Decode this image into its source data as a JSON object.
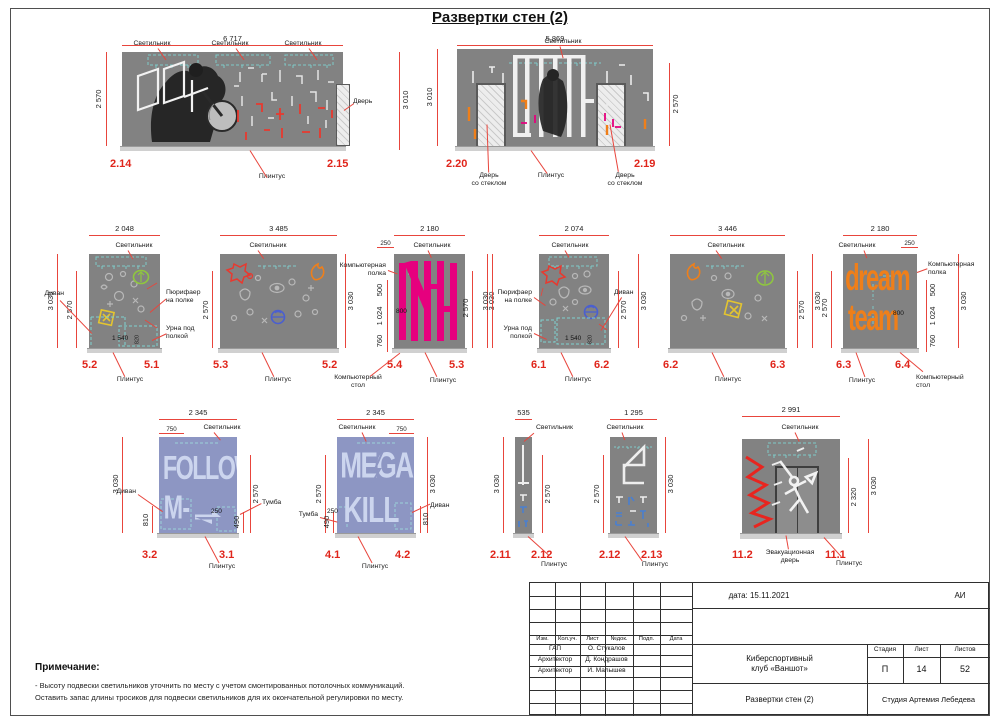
{
  "sheet": {
    "title": "Развертки стен (2)"
  },
  "colors": {
    "wall_gray": "#828282",
    "wall_periwinkle": "#8d96c3",
    "dim_red": "#e8453c",
    "id_red": "#e0251b",
    "lamp_teal": "#7fd2d0",
    "magenta": "#e6007e",
    "orange": "#ef7f1a"
  },
  "labels": {
    "lamp": "Светильник",
    "plinth": "Плинтус",
    "door": "Дверь",
    "glass_door": "Дверь\nсо стеклом",
    "sofa": "Диван",
    "purifier": "Пюрифаер\nна полке",
    "urn": "Урна под\nполкой",
    "shelf": "Компьютерная\nполка",
    "desk": "Компьютерный\nстол",
    "tumba": "Тумба",
    "evac_door": "Эвакуационная\nдверь"
  },
  "art": {
    "follow_line1": "FOLLOW",
    "follow_line2": "M-",
    "mega_line1": "MEGA",
    "mega_line2": "KILL",
    "dream_line1": "dream",
    "dream_line2": "team"
  },
  "walls": {
    "w2_14": {
      "top": "6 717",
      "h_left": "2 570",
      "h_right": "3 010",
      "id_left": "2.14",
      "id_right": "2.15"
    },
    "w2_20": {
      "top": "5 869",
      "h_left": "3 010",
      "h_right": "2 570",
      "id_left": "2.20",
      "id_right": "2.19"
    },
    "w5_2": {
      "top": "2 048",
      "h_out": "3 030",
      "h_in": "2 570",
      "w_in": "1 540",
      "h_small": "820",
      "id_left": "5.2",
      "id_right": "5.1"
    },
    "w5_3": {
      "top": "3 485",
      "h_left": "2 570",
      "h_right": "3 030",
      "id_left": "5.3",
      "id_right": "5.2"
    },
    "w5_4": {
      "top": "2 180",
      "offset": "250",
      "s1": "500",
      "s2": "1 024",
      "s3": "760",
      "inner": "800",
      "h_in": "2 570",
      "h_out": "3 030",
      "id_left": "5.4",
      "id_right": "5.3"
    },
    "w6_1": {
      "top": "2 074",
      "h_out_left": "3 030",
      "h_in": "2 570",
      "h_out_right": "3 030",
      "w_in": "1 540",
      "h_small": "820",
      "id_left": "6.1",
      "id_right": "6.2"
    },
    "w6_2": {
      "top": "3 446",
      "h_in": "2 570",
      "h_out": "3 030",
      "id_left": "6.2",
      "id_right": "6.3"
    },
    "w6_3": {
      "top": "2 180",
      "offset": "250",
      "h_left": "2 570",
      "s1": "500",
      "s2": "1 024",
      "s3": "760",
      "inner": "800",
      "h_out": "3 030",
      "id_left": "6.3",
      "id_right": "6.4"
    },
    "w3_2": {
      "top": "2 345",
      "offset": "750",
      "h_left": "3 030",
      "h_right": "2 570",
      "sofa": "810",
      "tumba": "490",
      "inner": "250",
      "id_left": "3.2",
      "id_right": "3.1"
    },
    "w4_1": {
      "top": "2 345",
      "offset": "750",
      "h_left": "2 570",
      "h_right": "3 030",
      "tumba": "490",
      "sofa": "810",
      "inner": "250",
      "id_left": "4.1",
      "id_right": "4.2"
    },
    "w2_11": {
      "top": "535",
      "h_left": "3 030",
      "h_right": "2 570",
      "id_left": "2.11",
      "id_right": "2.12"
    },
    "w2_12": {
      "top": "1 295",
      "h_left": "2 570",
      "h_right": "3 030",
      "id_left": "2.12",
      "id_right": "2.13"
    },
    "w11_2": {
      "top": "2 991",
      "h_in": "2 320",
      "h_out": "3 030",
      "id_left": "11.2",
      "id_right": "11.1"
    }
  },
  "note": {
    "title": "Примечание:",
    "line1": "- Высоту подвески светильников уточнить по месту с учетом смонтированных потолочных коммуникаций.",
    "line2": "Оставить запас длины тросиков для подвески светильников для их окончательной регулировки по месту."
  },
  "titleblock": {
    "date": "дата: 15.11.2021",
    "code": "АИ",
    "h_izm": "Изм.",
    "h_kol": "Кол.уч.",
    "h_list": "Лист",
    "h_ndoc": "№док.",
    "h_podp": "Подп.",
    "h_data": "Дата",
    "r1c1": "ГАП",
    "r1c2": "О. Стукалов",
    "r2c1": "Архитектор",
    "r2c2": "Д. Кондрашов",
    "r3c1": "Архитектор",
    "r3c2": "И. Малышев",
    "project": "Киберспортивный\nклуб «Ваншот»",
    "h_stage": "Стадия",
    "h_sheet": "Лист",
    "h_sheets": "Листов",
    "stage": "П",
    "sheet": "14",
    "sheets": "52",
    "doc": "Развертки стен (2)",
    "studio": "Студия Артемия Лебедева"
  }
}
